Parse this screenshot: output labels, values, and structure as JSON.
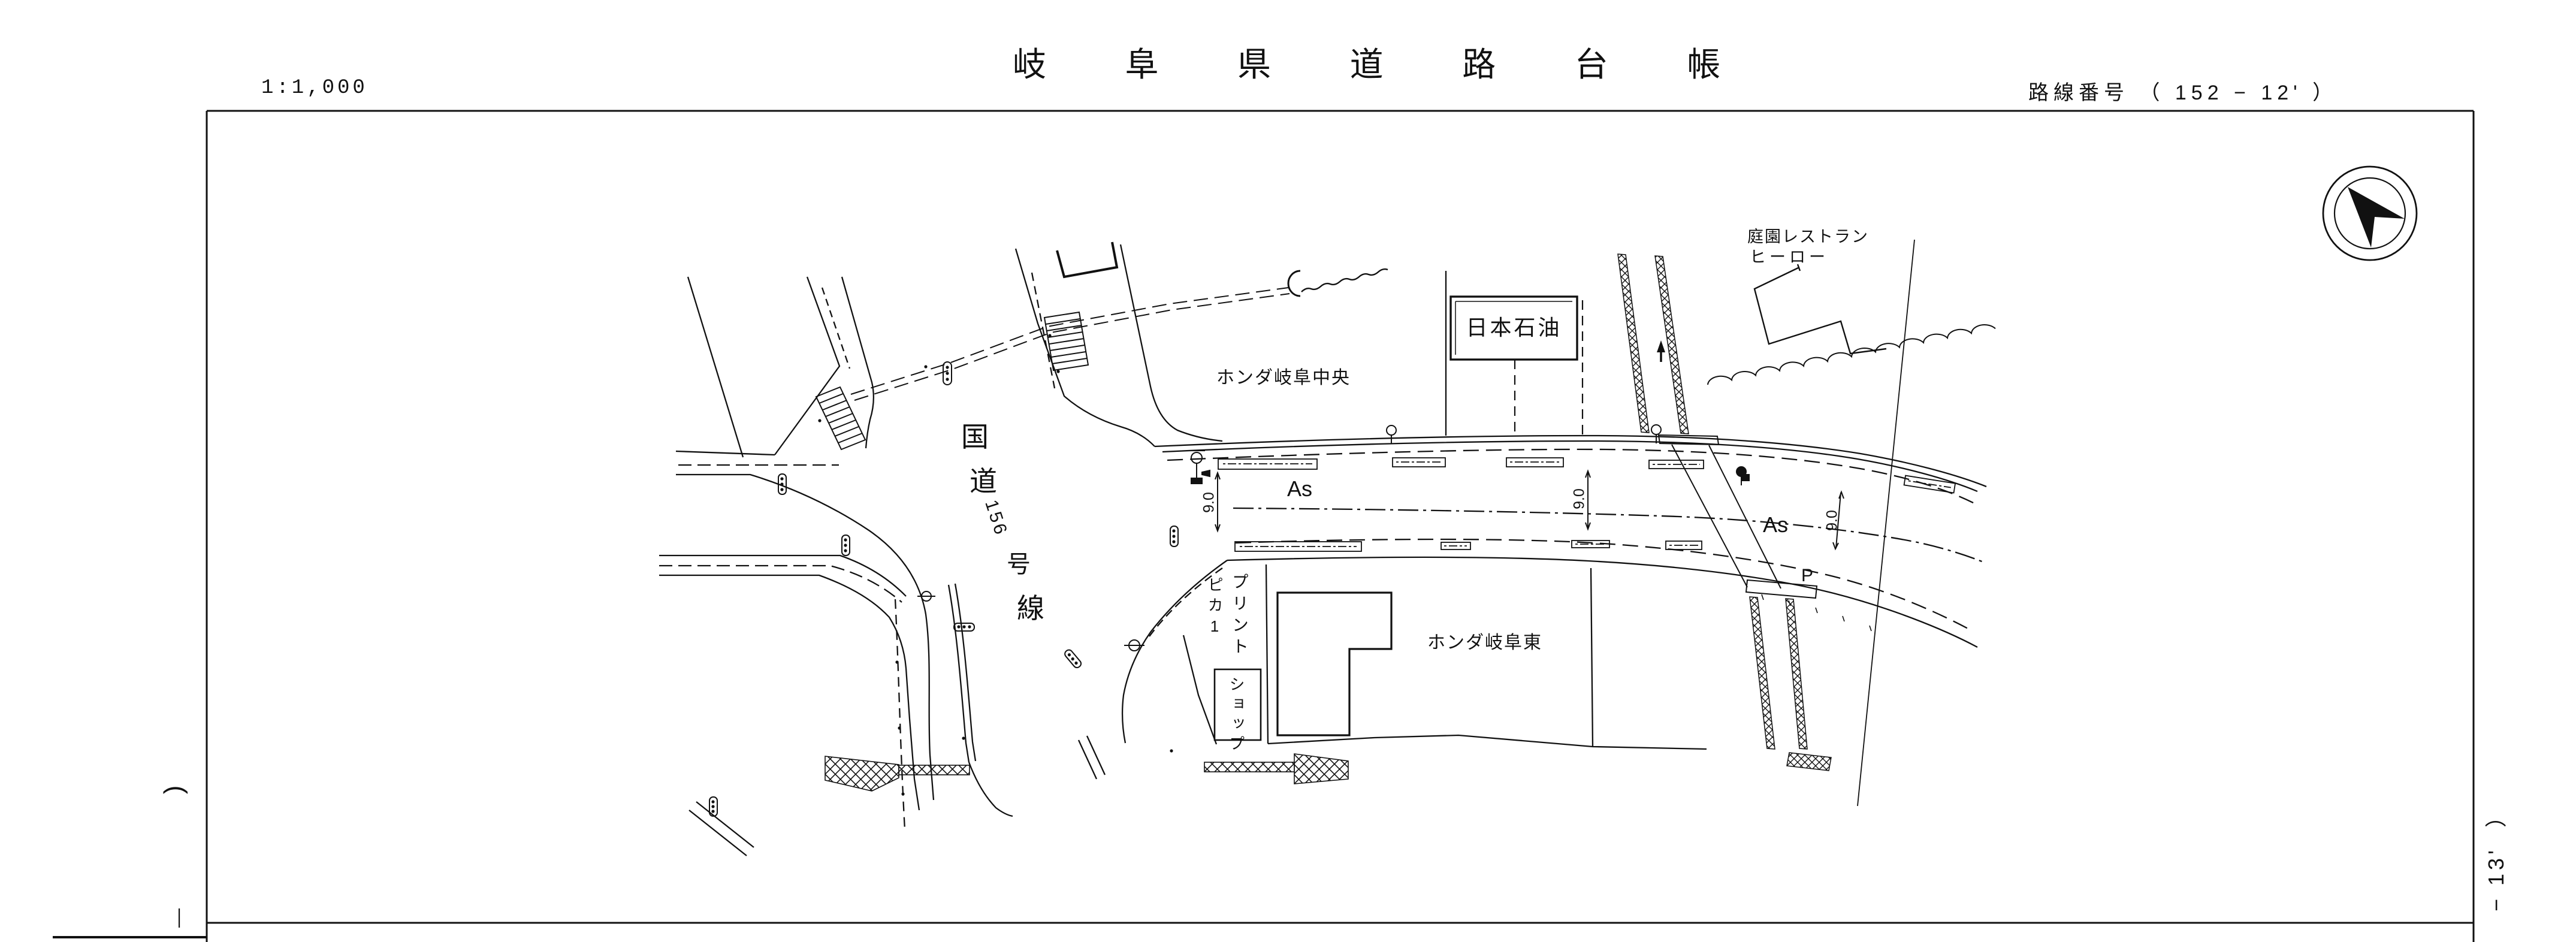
{
  "header": {
    "scale": "1:1,000",
    "title": "岐 阜 県 道 路 台 帳",
    "route_number": "路線番号 （ 152 − 12' ）"
  },
  "map": {
    "national_route_chars": [
      "国",
      "道",
      "156",
      "号",
      "線"
    ],
    "pavement_label_1": "As",
    "pavement_label_2": "As",
    "width_label_1": "9.0",
    "width_label_2": "9.0",
    "width_label_3": "9.0",
    "parking_label": "P",
    "gas_station": "日本石油",
    "honda_central": "ホンダ岐阜中央",
    "honda_east": "ホンダ岐阜東",
    "restaurant_line1": "庭園レストラン",
    "restaurant_line2": "ヒーロー",
    "print_shop_top": "プリント",
    "print_shop_boxed": "ショップ",
    "print_shop_name": "ピカ1",
    "compass_icon": "north-arrow"
  },
  "page_edges": {
    "left_bracket": "(",
    "left_dash": "―",
    "right_sheet_label": "− 13'  ）"
  }
}
